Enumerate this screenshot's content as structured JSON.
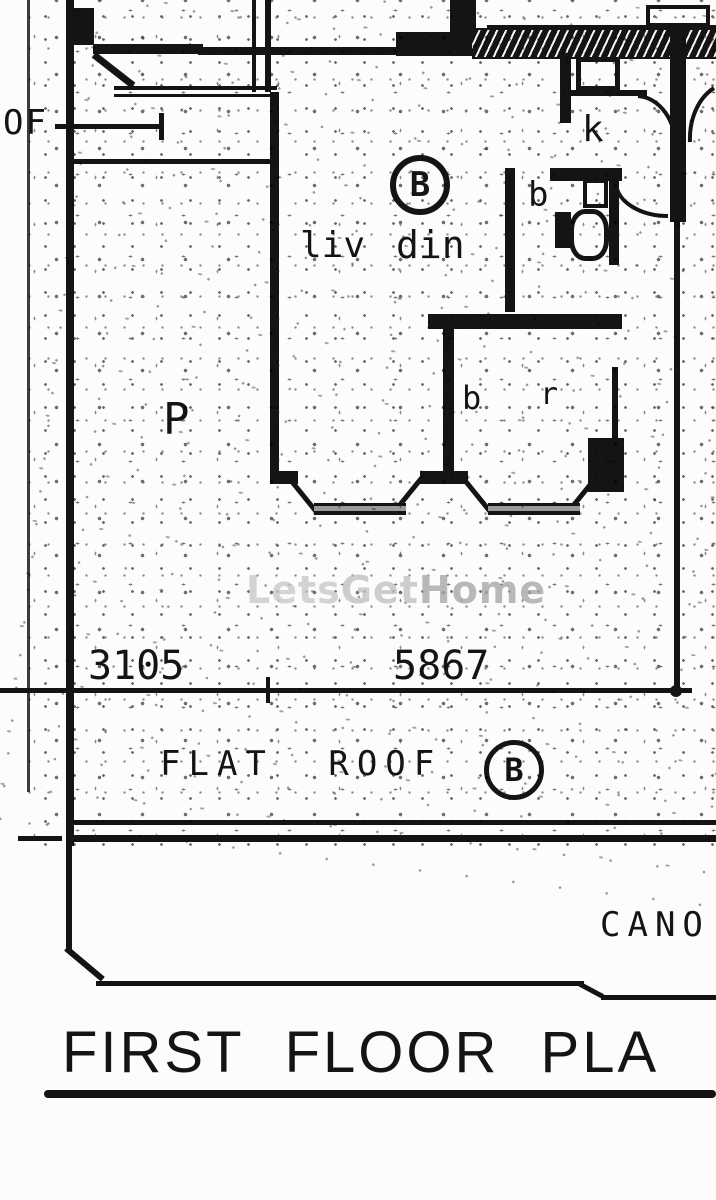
{
  "drawing": {
    "type": "architectural-floor-plan",
    "title": "FIRST FLOOR PLA",
    "labels": {
      "roof_left_edge": "OF",
      "unit_circle_top": "B",
      "living": "liv",
      "dining": "din",
      "kitchen": "k",
      "bathroom": "b",
      "bedroom_b": "b",
      "bedroom_r": "r",
      "left_area": "P",
      "flat_roof": "FLAT ROOF",
      "flat_roof_circle": "B",
      "canopy": "CANO"
    },
    "dimensions": {
      "left_span": "3105",
      "right_span": "5867"
    },
    "watermark": {
      "part1": "Lets",
      "part2": "Get",
      "part3": "Home"
    },
    "colors": {
      "ink": "#141414",
      "paper": "#fcfcfc",
      "watermark_light": "#cacaca",
      "watermark_dark": "#a8a8a8",
      "bay_sill_gray": "#9a9a9a"
    }
  }
}
